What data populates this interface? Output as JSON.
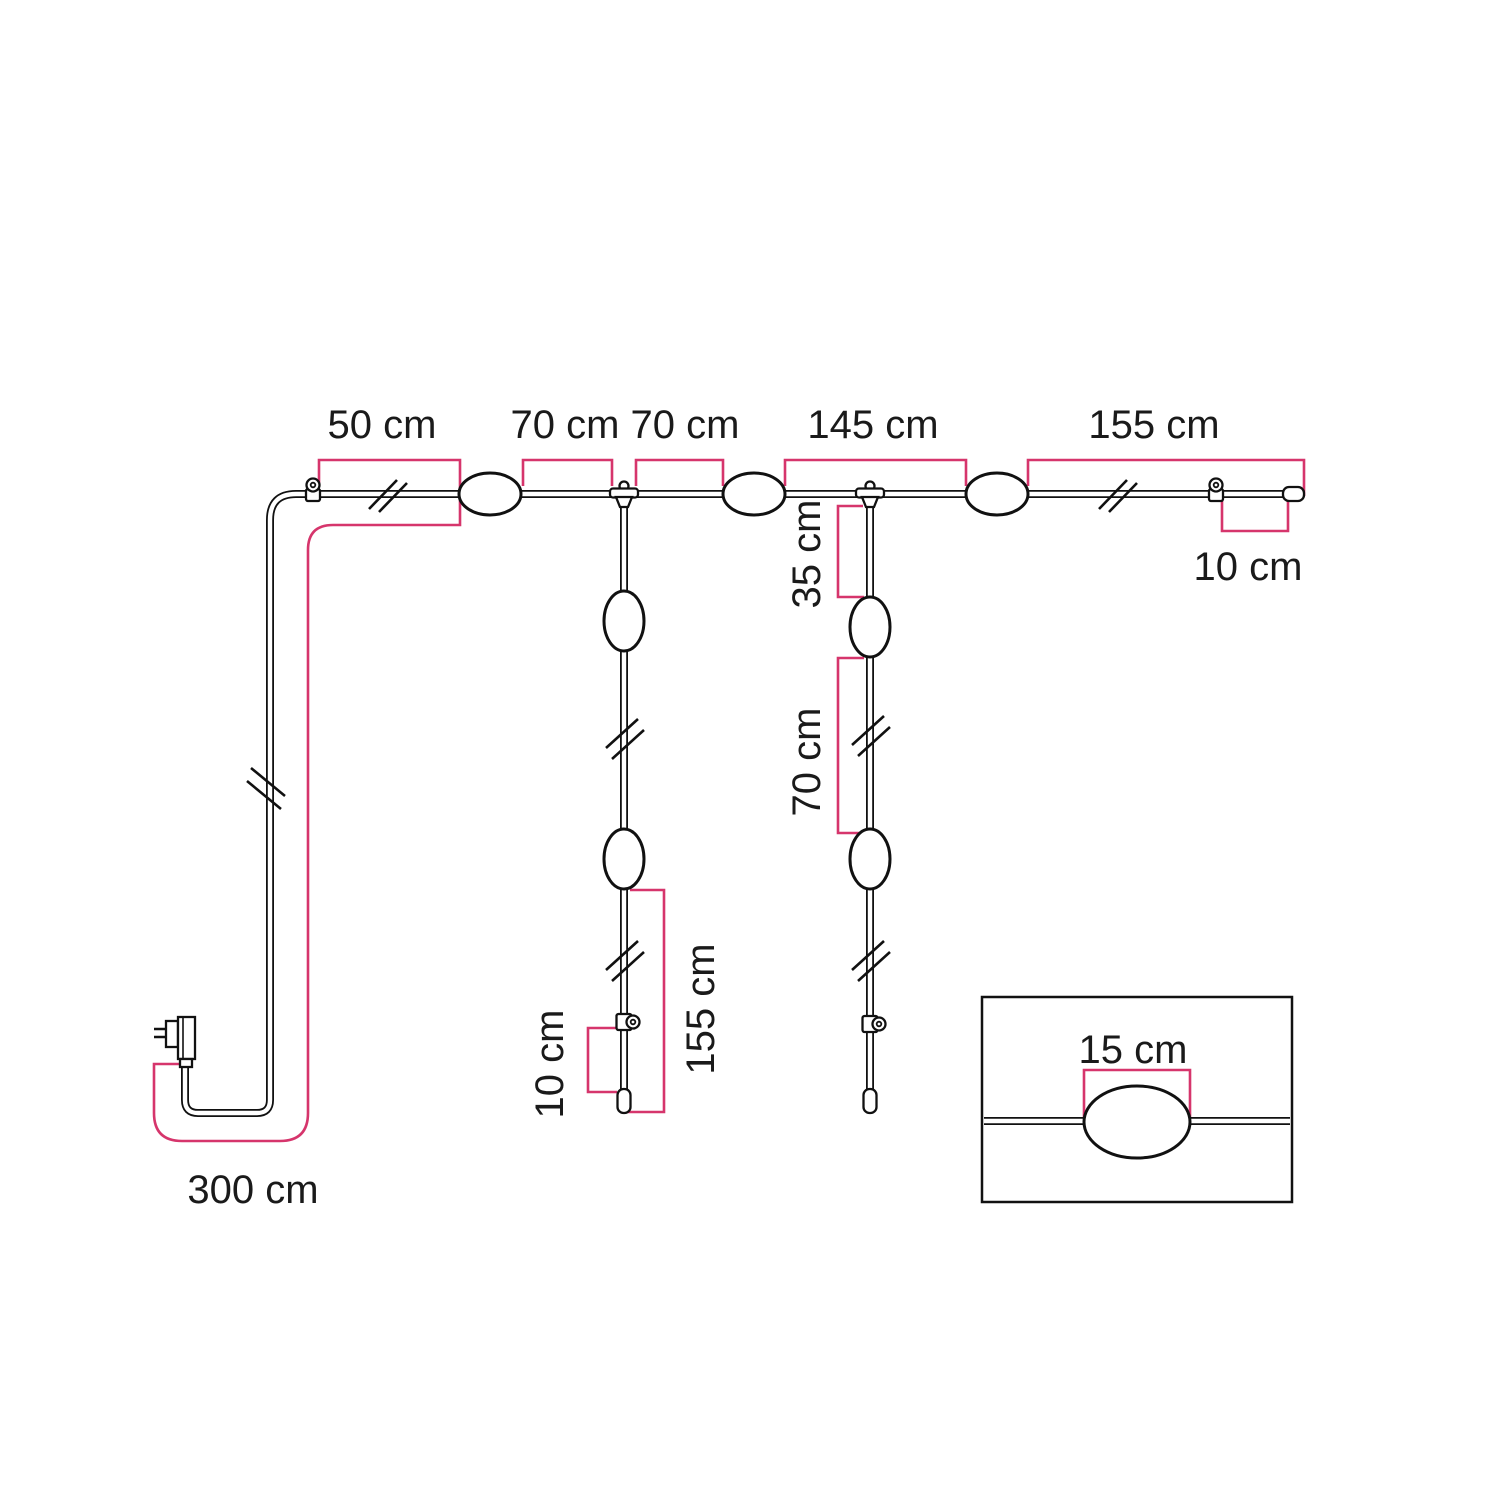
{
  "diagram": {
    "description": "Dimension drawing of a string light set with power plug, main run, two lamp drops and a lamp detail inset",
    "unit": "cm",
    "colors": {
      "dimension_line": "#d6356c",
      "artwork_line": "#111111",
      "label_text": "#1a1a1a",
      "background": "#ffffff"
    },
    "labels": {
      "top_run": {
        "seg_50": "50 cm",
        "seg_70_a": "70 cm",
        "seg_70_b": "70 cm",
        "seg_145": "145 cm",
        "seg_155": "155 cm",
        "end_10": "10 cm"
      },
      "drop_left": {
        "seg_155": "155 cm",
        "end_10": "10 cm"
      },
      "drop_right": {
        "seg_35": "35 cm",
        "seg_70": "70 cm"
      },
      "power_lead": {
        "seg_300": "300 cm"
      },
      "inset": {
        "lamp_15": "15 cm"
      }
    },
    "measurements": [
      {
        "value": 50,
        "unit": "cm",
        "location": "top run: wall hook to lamp 1"
      },
      {
        "value": 70,
        "unit": "cm",
        "location": "top run: lamp 1 to drop junction 1"
      },
      {
        "value": 70,
        "unit": "cm",
        "location": "top run: drop junction 1 to lamp 2"
      },
      {
        "value": 145,
        "unit": "cm",
        "location": "top run: lamp 2 to lamp 3"
      },
      {
        "value": 155,
        "unit": "cm",
        "location": "top run: lamp 3 to cable end"
      },
      {
        "value": 10,
        "unit": "cm",
        "location": "top run: end hook to cable tip"
      },
      {
        "value": 35,
        "unit": "cm",
        "location": "right drop: junction to lamp"
      },
      {
        "value": 70,
        "unit": "cm",
        "location": "right drop: lamp to lamp"
      },
      {
        "value": 155,
        "unit": "cm",
        "location": "left drop: lamp to cable tip"
      },
      {
        "value": 10,
        "unit": "cm",
        "location": "left drop: hook to cable tip"
      },
      {
        "value": 300,
        "unit": "cm",
        "location": "power lead: plug to first fixing"
      },
      {
        "value": 15,
        "unit": "cm",
        "location": "inset detail: lamp length"
      }
    ]
  }
}
